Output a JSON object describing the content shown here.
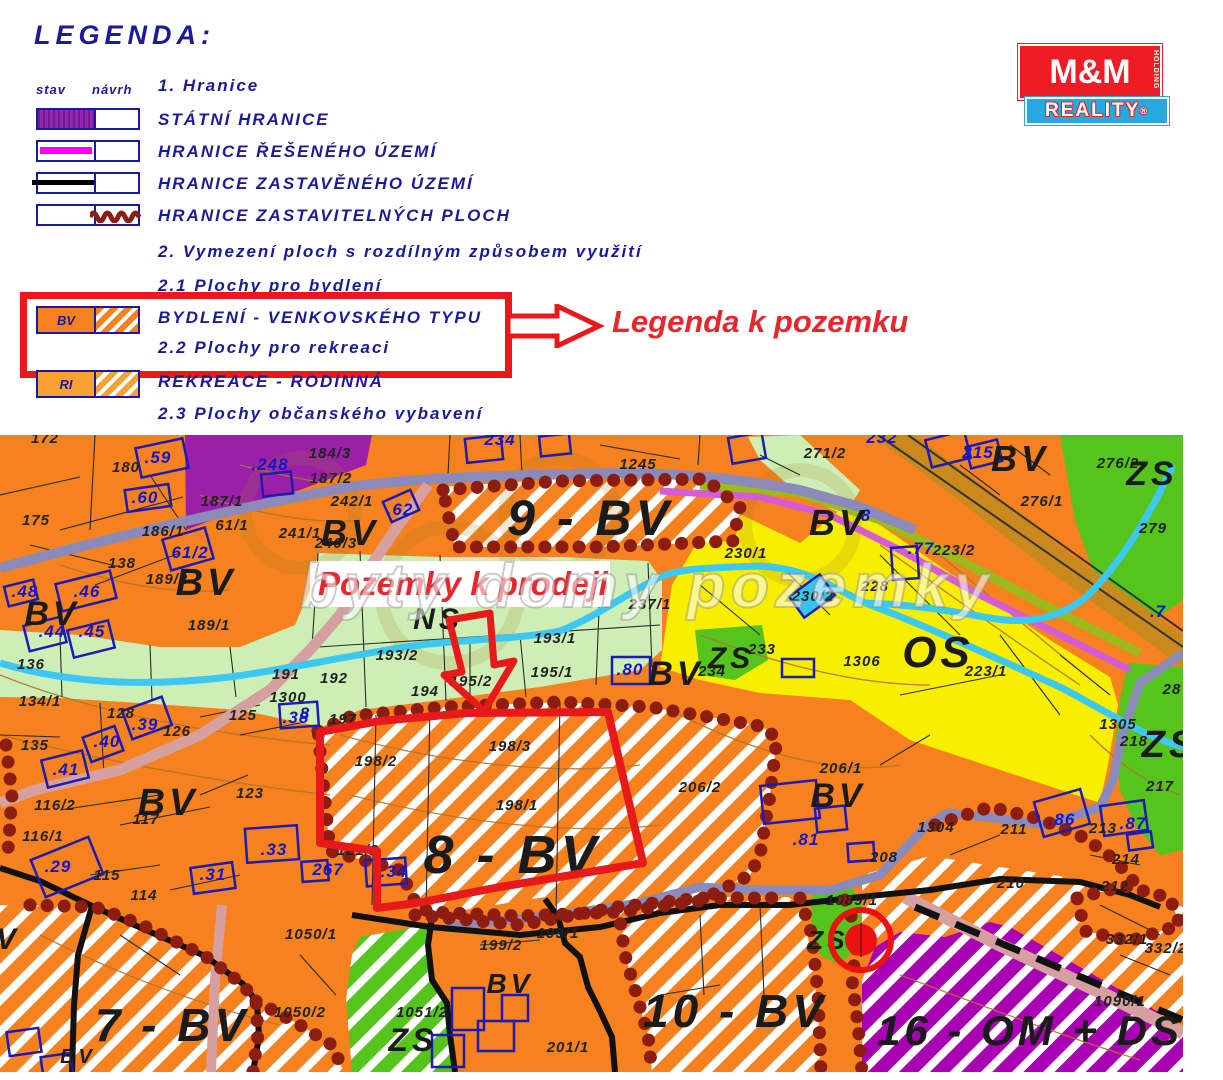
{
  "legend": {
    "title": "LEGENDA:",
    "col_stav": "stav",
    "col_navrh": "návrh",
    "section1": "1. Hranice",
    "rows": [
      {
        "label": "STÁTNÍ HRANICE",
        "swatch": "purple-fill"
      },
      {
        "label": "HRANICE ŘEŠENÉHO ÚZEMÍ",
        "swatch": "magenta-line"
      },
      {
        "label": "HRANICE ZASTAVĚNÉHO ÚZEMÍ",
        "swatch": "black-line"
      },
      {
        "label": "HRANICE ZASTAVITELNÝCH PLOCH",
        "swatch": "darkred-wavy"
      }
    ],
    "section2": "2. Vymezení ploch s rozdílným způsobem využití",
    "section2_1": "2.1 Plochy pro bydlení",
    "bv_code": "BV",
    "bv_label": "BYDLENÍ - VENKOVSKÉHO TYPU",
    "section2_2": "2.2 Plochy pro rekreaci",
    "ri_code": "RI",
    "ri_label": "REKREACE - RODINNÁ",
    "section2_3": "2.3 Plochy občanského vybavení",
    "callout": "Legenda k pozemku"
  },
  "logo": {
    "top": "M&M",
    "holding": "HOLDING",
    "bottom": "REALITY",
    "reg": "®"
  },
  "map": {
    "sale_label": "Pozemky k prodeji",
    "watermark": "byty domy pozemky",
    "zone_labels": [
      {
        "t": "9 - BV",
        "x": 590,
        "y": 100,
        "s": 50
      },
      {
        "t": "8 - BV",
        "x": 512,
        "y": 438,
        "s": 54
      },
      {
        "t": "7 - BV",
        "x": 172,
        "y": 606,
        "s": 46
      },
      {
        "t": "10 - BV",
        "x": 735,
        "y": 592,
        "s": 46
      },
      {
        "t": "16 - OM + DS",
        "x": 1030,
        "y": 610,
        "s": 42
      },
      {
        "t": "OS",
        "x": 938,
        "y": 232,
        "s": 44
      },
      {
        "t": "ZS",
        "x": 1152,
        "y": 50,
        "s": 34
      },
      {
        "t": "ZS",
        "x": 1170,
        "y": 322,
        "s": 38
      },
      {
        "t": "ZS",
        "x": 731,
        "y": 233,
        "s": 30
      },
      {
        "t": "ZS",
        "x": 828,
        "y": 514,
        "s": 26
      },
      {
        "t": "ZS",
        "x": 413,
        "y": 616,
        "s": 32
      },
      {
        "t": "NS",
        "x": 438,
        "y": 194,
        "s": 30
      },
      {
        "t": "BV",
        "x": 52,
        "y": 190,
        "s": 34
      },
      {
        "t": "BV",
        "x": 206,
        "y": 160,
        "s": 38
      },
      {
        "t": "BV",
        "x": 350,
        "y": 110,
        "s": 36
      },
      {
        "t": "BV",
        "x": 168,
        "y": 380,
        "s": 38
      },
      {
        "t": "BV",
        "x": 676,
        "y": 250,
        "s": 34
      },
      {
        "t": "BV",
        "x": 838,
        "y": 100,
        "s": 36
      },
      {
        "t": "BV",
        "x": 1020,
        "y": 36,
        "s": 36
      },
      {
        "t": "BV",
        "x": 838,
        "y": 372,
        "s": 34
      },
      {
        "t": "BV",
        "x": 510,
        "y": 558,
        "s": 28
      },
      {
        "t": "BV",
        "x": 78,
        "y": 628,
        "s": 20
      },
      {
        "t": "V",
        "x": 8,
        "y": 514,
        "s": 30
      }
    ],
    "parcel_labels": [
      {
        "t": ".59",
        "x": 158,
        "y": 28,
        "c": "b"
      },
      {
        "t": ".60",
        "x": 145,
        "y": 68,
        "c": "b"
      },
      {
        "t": ".248",
        "x": 270,
        "y": 35,
        "c": "b"
      },
      {
        "t": ".62",
        "x": 400,
        "y": 80,
        "c": "b"
      },
      {
        "t": ".46",
        "x": 87,
        "y": 162,
        "c": "b"
      },
      {
        "t": ".48",
        "x": 25,
        "y": 162,
        "c": "b"
      },
      {
        "t": ".44",
        "x": 52,
        "y": 202,
        "c": "b"
      },
      {
        "t": ".45",
        "x": 92,
        "y": 202,
        "c": "b"
      },
      {
        "t": "61/2",
        "x": 190,
        "y": 123,
        "c": "b"
      },
      {
        "t": ".38",
        "x": 296,
        "y": 288,
        "c": "b"
      },
      {
        "t": ".39",
        "x": 145,
        "y": 295,
        "c": "b"
      },
      {
        "t": ".40",
        "x": 107,
        "y": 312,
        "c": "b"
      },
      {
        "t": ".41",
        "x": 66,
        "y": 340,
        "c": "b"
      },
      {
        "t": ".29",
        "x": 58,
        "y": 437,
        "c": "b"
      },
      {
        "t": ".31",
        "x": 213,
        "y": 445,
        "c": "b"
      },
      {
        "t": ".33",
        "x": 274,
        "y": 420,
        "c": "b"
      },
      {
        "t": ".34",
        "x": 394,
        "y": 442,
        "c": "b"
      },
      {
        "t": "267",
        "x": 328,
        "y": 440,
        "c": "b"
      },
      {
        "t": "8",
        "x": 305,
        "y": 284,
        "c": "b"
      },
      {
        "t": ".80",
        "x": 630,
        "y": 240,
        "c": "b"
      },
      {
        "t": "215",
        "x": 978,
        "y": 23,
        "c": "b"
      },
      {
        "t": ".77",
        "x": 921,
        "y": 119,
        "c": "b"
      },
      {
        "t": ".86",
        "x": 1062,
        "y": 390,
        "c": "b"
      },
      {
        "t": ".87",
        "x": 1133,
        "y": 394,
        "c": "b"
      },
      {
        "t": ".81",
        "x": 806,
        "y": 410,
        "c": "b"
      },
      {
        "t": "234",
        "x": 500,
        "y": 10,
        "c": "b"
      },
      {
        "t": "232",
        "x": 882,
        "y": 8,
        "c": "b"
      },
      {
        "t": ".7",
        "x": 1158,
        "y": 182,
        "c": "b"
      },
      {
        "t": "8",
        "x": 866,
        "y": 86,
        "c": "b"
      },
      {
        "t": "172",
        "x": 45,
        "y": 8,
        "c": "k"
      },
      {
        "t": "175",
        "x": 36,
        "y": 90,
        "c": "k"
      },
      {
        "t": "180",
        "x": 126,
        "y": 37,
        "c": "k"
      },
      {
        "t": "186/1",
        "x": 163,
        "y": 101,
        "c": "k"
      },
      {
        "t": "61/1",
        "x": 232,
        "y": 95,
        "c": "k"
      },
      {
        "t": "184/3",
        "x": 330,
        "y": 23,
        "c": "k"
      },
      {
        "t": "187/2",
        "x": 331,
        "y": 48,
        "c": "k"
      },
      {
        "t": "187/1",
        "x": 222,
        "y": 71,
        "c": "k"
      },
      {
        "t": "242/1",
        "x": 352,
        "y": 71,
        "c": "k"
      },
      {
        "t": "241/1",
        "x": 300,
        "y": 103,
        "c": "k"
      },
      {
        "t": "240/3",
        "x": 336,
        "y": 113,
        "c": "k"
      },
      {
        "t": "138",
        "x": 122,
        "y": 133,
        "c": "k"
      },
      {
        "t": "189/2",
        "x": 167,
        "y": 149,
        "c": "k"
      },
      {
        "t": "189/1",
        "x": 209,
        "y": 195,
        "c": "k"
      },
      {
        "t": "136",
        "x": 31,
        "y": 234,
        "c": "k"
      },
      {
        "t": "134/1",
        "x": 40,
        "y": 271,
        "c": "k"
      },
      {
        "t": "135",
        "x": 35,
        "y": 315,
        "c": "k"
      },
      {
        "t": "128",
        "x": 121,
        "y": 283,
        "c": "k"
      },
      {
        "t": "126",
        "x": 177,
        "y": 301,
        "c": "k"
      },
      {
        "t": "125",
        "x": 243,
        "y": 285,
        "c": "k"
      },
      {
        "t": "191",
        "x": 286,
        "y": 244,
        "c": "k"
      },
      {
        "t": "1300",
        "x": 288,
        "y": 267,
        "c": "k"
      },
      {
        "t": "192",
        "x": 334,
        "y": 248,
        "c": "k"
      },
      {
        "t": "116/2",
        "x": 55,
        "y": 375,
        "c": "k"
      },
      {
        "t": "116/1",
        "x": 43,
        "y": 406,
        "c": "k"
      },
      {
        "t": "115",
        "x": 107,
        "y": 445,
        "c": "k"
      },
      {
        "t": "114",
        "x": 144,
        "y": 465,
        "c": "k"
      },
      {
        "t": "117",
        "x": 146,
        "y": 389,
        "c": "k"
      },
      {
        "t": "123",
        "x": 250,
        "y": 363,
        "c": "k"
      },
      {
        "t": "197",
        "x": 343,
        "y": 289,
        "c": "k"
      },
      {
        "t": "193/2",
        "x": 397,
        "y": 225,
        "c": "k"
      },
      {
        "t": "193/1",
        "x": 555,
        "y": 208,
        "c": "k"
      },
      {
        "t": "194",
        "x": 425,
        "y": 261,
        "c": "k"
      },
      {
        "t": "195/2",
        "x": 471,
        "y": 251,
        "c": "k"
      },
      {
        "t": "195/1",
        "x": 552,
        "y": 242,
        "c": "k"
      },
      {
        "t": "237/1",
        "x": 650,
        "y": 174,
        "c": "k"
      },
      {
        "t": "230/1",
        "x": 746,
        "y": 123,
        "c": "k"
      },
      {
        "t": "230/2",
        "x": 813,
        "y": 166,
        "c": "k"
      },
      {
        "t": "1245",
        "x": 638,
        "y": 34,
        "c": "k"
      },
      {
        "t": "271/2",
        "x": 825,
        "y": 23,
        "c": "k"
      },
      {
        "t": "276/2",
        "x": 1118,
        "y": 33,
        "c": "k"
      },
      {
        "t": "276/1",
        "x": 1042,
        "y": 71,
        "c": "k"
      },
      {
        "t": "279",
        "x": 1153,
        "y": 98,
        "c": "k"
      },
      {
        "t": "223/2",
        "x": 954,
        "y": 120,
        "c": "k"
      },
      {
        "t": "228",
        "x": 875,
        "y": 156,
        "c": "k"
      },
      {
        "t": "223/1",
        "x": 986,
        "y": 241,
        "c": "k"
      },
      {
        "t": "1306",
        "x": 862,
        "y": 231,
        "c": "k"
      },
      {
        "t": "233",
        "x": 762,
        "y": 219,
        "c": "k"
      },
      {
        "t": "234",
        "x": 712,
        "y": 241,
        "c": "k"
      },
      {
        "t": "198/2",
        "x": 376,
        "y": 331,
        "c": "k"
      },
      {
        "t": "198/3",
        "x": 510,
        "y": 316,
        "c": "k"
      },
      {
        "t": "198/1",
        "x": 517,
        "y": 375,
        "c": "k"
      },
      {
        "t": "206/2",
        "x": 700,
        "y": 357,
        "c": "k"
      },
      {
        "t": "206/1",
        "x": 841,
        "y": 338,
        "c": "k"
      },
      {
        "t": "208",
        "x": 884,
        "y": 427,
        "c": "k"
      },
      {
        "t": "1304",
        "x": 936,
        "y": 397,
        "c": "k"
      },
      {
        "t": "211",
        "x": 1014,
        "y": 399,
        "c": "k"
      },
      {
        "t": "213",
        "x": 1103,
        "y": 398,
        "c": "k"
      },
      {
        "t": "214",
        "x": 1126,
        "y": 429,
        "c": "k"
      },
      {
        "t": "212",
        "x": 1115,
        "y": 456,
        "c": "k"
      },
      {
        "t": "210",
        "x": 1011,
        "y": 453,
        "c": "k"
      },
      {
        "t": "1305",
        "x": 1118,
        "y": 294,
        "c": "k"
      },
      {
        "t": "218",
        "x": 1134,
        "y": 311,
        "c": "k"
      },
      {
        "t": "28",
        "x": 1172,
        "y": 259,
        "c": "k"
      },
      {
        "t": "217",
        "x": 1160,
        "y": 356,
        "c": "k"
      },
      {
        "t": "332/1",
        "x": 1127,
        "y": 509,
        "c": "k"
      },
      {
        "t": "332/2",
        "x": 1166,
        "y": 518,
        "c": "k"
      },
      {
        "t": "1090/1",
        "x": 1120,
        "y": 571,
        "c": "k"
      },
      {
        "t": "1089/1",
        "x": 852,
        "y": 470,
        "c": "k"
      },
      {
        "t": "1050/1",
        "x": 311,
        "y": 504,
        "c": "k"
      },
      {
        "t": "1050/2",
        "x": 300,
        "y": 582,
        "c": "k"
      },
      {
        "t": "1051/2",
        "x": 422,
        "y": 582,
        "c": "k"
      },
      {
        "t": "199/2",
        "x": 501,
        "y": 515,
        "c": "k"
      },
      {
        "t": "199/1",
        "x": 558,
        "y": 503,
        "c": "k"
      },
      {
        "t": "201/1",
        "x": 568,
        "y": 617,
        "c": "k"
      },
      {
        "t": "121/2",
        "x": 358,
        "y": 420,
        "c": "k"
      }
    ]
  },
  "colors": {
    "legend_navy": "#1a1a9c",
    "highlight_red": "#e8191b",
    "zone_orange_bv": "#f5821e",
    "zone_yellow_os": "#f7ee00",
    "zone_green_zs": "#55c41d",
    "zone_lightgreen_ns": "#cdefb5",
    "zone_purple": "#9c1fa8",
    "zone_purple_omds": "#aa00b4",
    "road_slate": "#8a8abb",
    "road_ochre": "#c9891c",
    "road_magenta": "#d65cd6",
    "road_pink": "#d6a0a0",
    "stream_cyan": "#3cc8f0",
    "boundary_darkred": "#8c1d10",
    "parcel_text_blue": "#1616c8",
    "logo_red": "#ee1c25",
    "logo_blue": "#29a8e0"
  }
}
